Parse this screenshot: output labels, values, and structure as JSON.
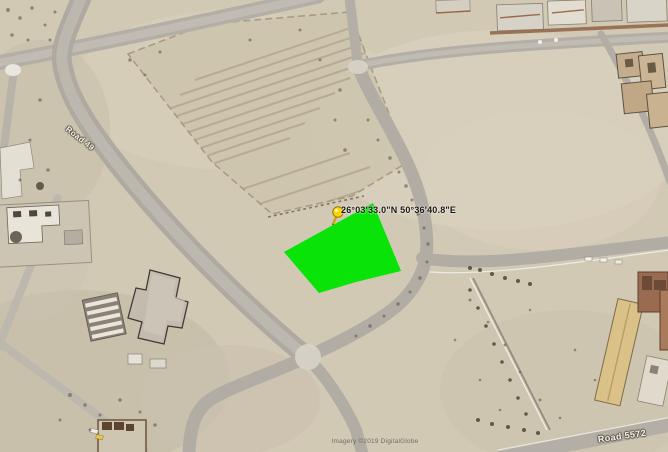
{
  "map": {
    "view_type": "satellite",
    "placemark": {
      "coordinates_label": "26°03'33.0\"N 50°36'40.8\"E",
      "pin_icon": "yellow-pushpin",
      "pin_color": "#ffd500"
    },
    "highlighted_plot": {
      "description": "selected land plot polygon",
      "fill_color": "#00e400"
    },
    "road_labels": [
      {
        "label": "Road 49"
      },
      {
        "label": "Road 5572"
      }
    ],
    "watermark": "Imagery ©2019 DigitalGlobe",
    "colors": {
      "sand": "#d2c9b5",
      "road": "#a9a59c",
      "plot_highlight": "#00e400",
      "pin": "#ffd500"
    }
  }
}
